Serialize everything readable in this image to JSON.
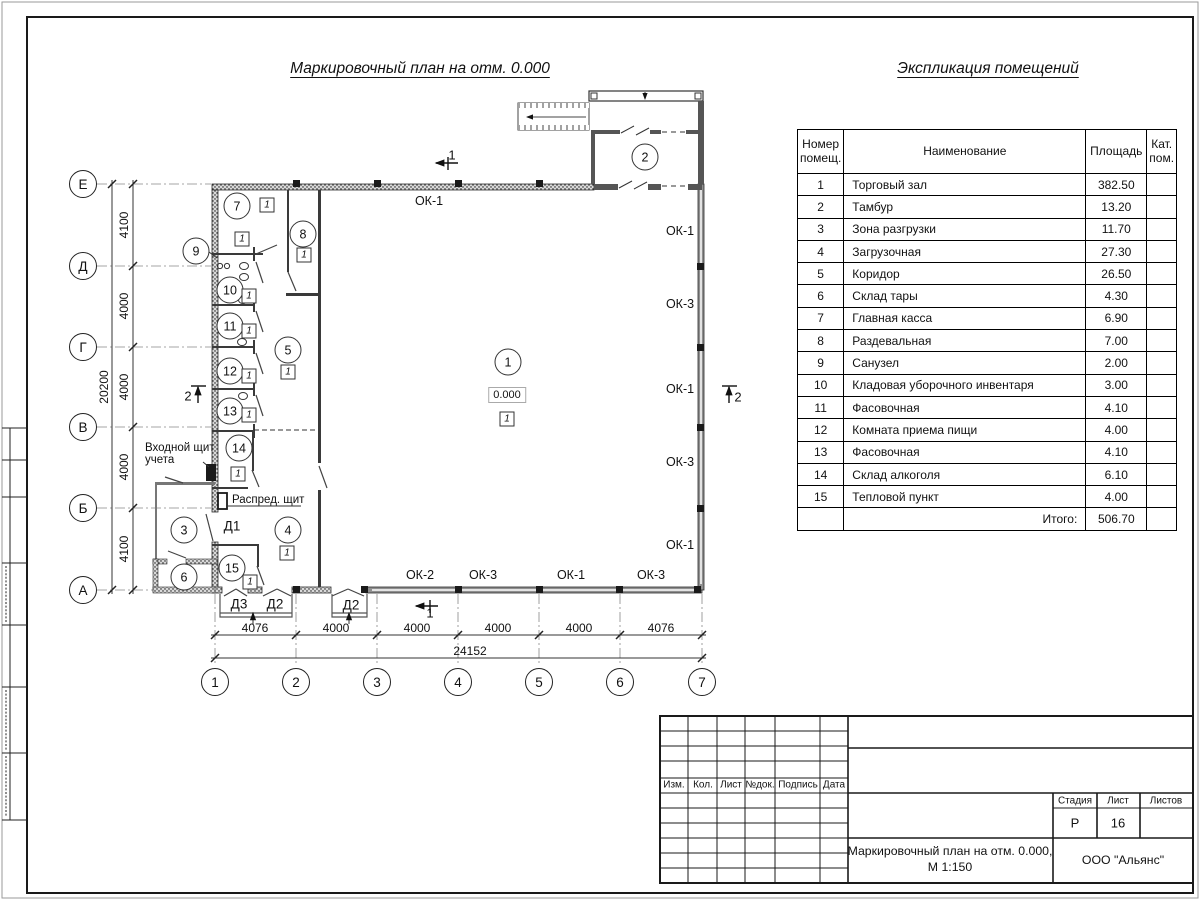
{
  "titles": {
    "plan": "Маркировочный план на отм. 0.000",
    "table": "Экспликация помещений"
  },
  "rooms_table": {
    "col_headers": [
      "Номер помещ.",
      "Наименование",
      "Площадь",
      "Кат. пом."
    ],
    "rows": [
      {
        "num": "1",
        "name": "Торговый зал",
        "area": "382.50",
        "cat": ""
      },
      {
        "num": "2",
        "name": "Тамбур",
        "area": "13.20",
        "cat": ""
      },
      {
        "num": "3",
        "name": "Зона разгрузки",
        "area": "11.70",
        "cat": ""
      },
      {
        "num": "4",
        "name": "Загрузочная",
        "area": "27.30",
        "cat": ""
      },
      {
        "num": "5",
        "name": "Коридор",
        "area": "26.50",
        "cat": ""
      },
      {
        "num": "6",
        "name": "Склад тары",
        "area": "4.30",
        "cat": ""
      },
      {
        "num": "7",
        "name": "Главная касса",
        "area": "6.90",
        "cat": ""
      },
      {
        "num": "8",
        "name": "Раздевальная",
        "area": "7.00",
        "cat": ""
      },
      {
        "num": "9",
        "name": "Санузел",
        "area": "2.00",
        "cat": ""
      },
      {
        "num": "10",
        "name": "Кладовая уборочного инвентаря",
        "area": "3.00",
        "cat": ""
      },
      {
        "num": "11",
        "name": "Фасовочная",
        "area": "4.10",
        "cat": ""
      },
      {
        "num": "12",
        "name": "Комната приема пищи",
        "area": "4.00",
        "cat": ""
      },
      {
        "num": "13",
        "name": "Фасовочная",
        "area": "4.10",
        "cat": ""
      },
      {
        "num": "14",
        "name": "Склад алкоголя",
        "area": "6.10",
        "cat": ""
      },
      {
        "num": "15",
        "name": "Тепловой пункт",
        "area": "4.00",
        "cat": ""
      }
    ],
    "total_label": "Итого:",
    "total_area": "506.70"
  },
  "plan": {
    "elevation": "0.000",
    "marker_text": "1",
    "axis_rows": [
      {
        "label": "Е",
        "y": 184
      },
      {
        "label": "Д",
        "y": 266
      },
      {
        "label": "Г",
        "y": 347
      },
      {
        "label": "В",
        "y": 427
      },
      {
        "label": "Б",
        "y": 508
      },
      {
        "label": "А",
        "y": 590
      }
    ],
    "axis_cols": [
      {
        "label": "1",
        "x": 215
      },
      {
        "label": "2",
        "x": 296
      },
      {
        "label": "3",
        "x": 377
      },
      {
        "label": "4",
        "x": 458
      },
      {
        "label": "5",
        "x": 539
      },
      {
        "label": "6",
        "x": 620
      },
      {
        "label": "7",
        "x": 702
      }
    ],
    "room_circles": [
      {
        "label": "1",
        "x": 508,
        "y": 362
      },
      {
        "label": "2",
        "x": 645,
        "y": 157
      },
      {
        "label": "3",
        "x": 184,
        "y": 530
      },
      {
        "label": "4",
        "x": 288,
        "y": 530
      },
      {
        "label": "5",
        "x": 288,
        "y": 350
      },
      {
        "label": "6",
        "x": 184,
        "y": 577
      },
      {
        "label": "7",
        "x": 237,
        "y": 206
      },
      {
        "label": "8",
        "x": 303,
        "y": 234
      },
      {
        "label": "9",
        "x": 196,
        "y": 251
      },
      {
        "label": "10",
        "x": 230,
        "y": 290
      },
      {
        "label": "11",
        "x": 230,
        "y": 326
      },
      {
        "label": "12",
        "x": 230,
        "y": 371
      },
      {
        "label": "13",
        "x": 230,
        "y": 411
      },
      {
        "label": "14",
        "x": 239,
        "y": 448
      },
      {
        "label": "15",
        "x": 232,
        "y": 568
      }
    ],
    "markers": [
      {
        "x": 267,
        "y": 205
      },
      {
        "x": 304,
        "y": 255
      },
      {
        "x": 242,
        "y": 239
      },
      {
        "x": 249,
        "y": 296
      },
      {
        "x": 249,
        "y": 331
      },
      {
        "x": 288,
        "y": 372
      },
      {
        "x": 249,
        "y": 376
      },
      {
        "x": 249,
        "y": 415
      },
      {
        "x": 238,
        "y": 474
      },
      {
        "x": 287,
        "y": 553
      },
      {
        "x": 250,
        "y": 582
      },
      {
        "x": 507,
        "y": 419
      }
    ],
    "window_labels": [
      {
        "text": "ОК-1",
        "x": 429,
        "y": 201
      },
      {
        "text": "ОК-1",
        "x": 680,
        "y": 231
      },
      {
        "text": "ОК-3",
        "x": 680,
        "y": 304
      },
      {
        "text": "ОК-1",
        "x": 680,
        "y": 389
      },
      {
        "text": "ОК-3",
        "x": 680,
        "y": 462
      },
      {
        "text": "ОК-1",
        "x": 680,
        "y": 545
      },
      {
        "text": "ОК-2",
        "x": 420,
        "y": 575
      },
      {
        "text": "ОК-3",
        "x": 483,
        "y": 575
      },
      {
        "text": "ОК-1",
        "x": 571,
        "y": 575
      },
      {
        "text": "ОК-3",
        "x": 651,
        "y": 575
      }
    ],
    "door_labels": [
      {
        "text": "Д1",
        "x": 232,
        "y": 526
      },
      {
        "text": "Д3",
        "x": 239,
        "y": 604
      },
      {
        "text": "Д2",
        "x": 275,
        "y": 604
      },
      {
        "text": "Д2",
        "x": 351,
        "y": 605
      }
    ],
    "section_labels": [
      {
        "text": "1",
        "x": 452,
        "y": 155
      },
      {
        "text": "1",
        "x": 430,
        "y": 613
      },
      {
        "text": "2",
        "x": 188,
        "y": 396
      },
      {
        "text": "2",
        "x": 738,
        "y": 397
      }
    ],
    "dim_v": [
      {
        "text": "4100",
        "x": 124,
        "y": 225
      },
      {
        "text": "4000",
        "x": 124,
        "y": 306
      },
      {
        "text": "4000",
        "x": 124,
        "y": 387
      },
      {
        "text": "4000",
        "x": 124,
        "y": 467
      },
      {
        "text": "4100",
        "x": 124,
        "y": 549
      },
      {
        "text": "20200",
        "x": 104,
        "y": 387
      }
    ],
    "dim_h": [
      {
        "text": "4076",
        "x": 255,
        "y": 628
      },
      {
        "text": "4000",
        "x": 336,
        "y": 628
      },
      {
        "text": "4000",
        "x": 417,
        "y": 628
      },
      {
        "text": "4000",
        "x": 498,
        "y": 628
      },
      {
        "text": "4000",
        "x": 579,
        "y": 628
      },
      {
        "text": "4076",
        "x": 661,
        "y": 628
      },
      {
        "text": "24152",
        "x": 470,
        "y": 651
      }
    ],
    "annotations": [
      {
        "text": "Входной щит",
        "x": 145,
        "y": 448
      },
      {
        "text": "учета",
        "x": 145,
        "y": 460
      },
      {
        "text": "Распред. щит",
        "x": 232,
        "y": 500
      }
    ]
  },
  "title_block": {
    "rev_headers": [
      {
        "text": "Изм.",
        "x": 674
      },
      {
        "text": "Кол.",
        "x": 703
      },
      {
        "text": "Лист",
        "x": 731
      },
      {
        "text": "№док.",
        "x": 760
      },
      {
        "text": "Подпись",
        "x": 798
      },
      {
        "text": "Дата",
        "x": 834
      }
    ],
    "stage_label": "Стадия",
    "sheet_label": "Лист",
    "sheets_label": "Листов",
    "stage_value": "Р",
    "sheet_value": "16",
    "sheets_value": "",
    "doc_title_line1": "Маркировочный план на отм. 0.000,",
    "doc_title_line2": "М 1:150",
    "company": "ООО \"Альянс\""
  }
}
